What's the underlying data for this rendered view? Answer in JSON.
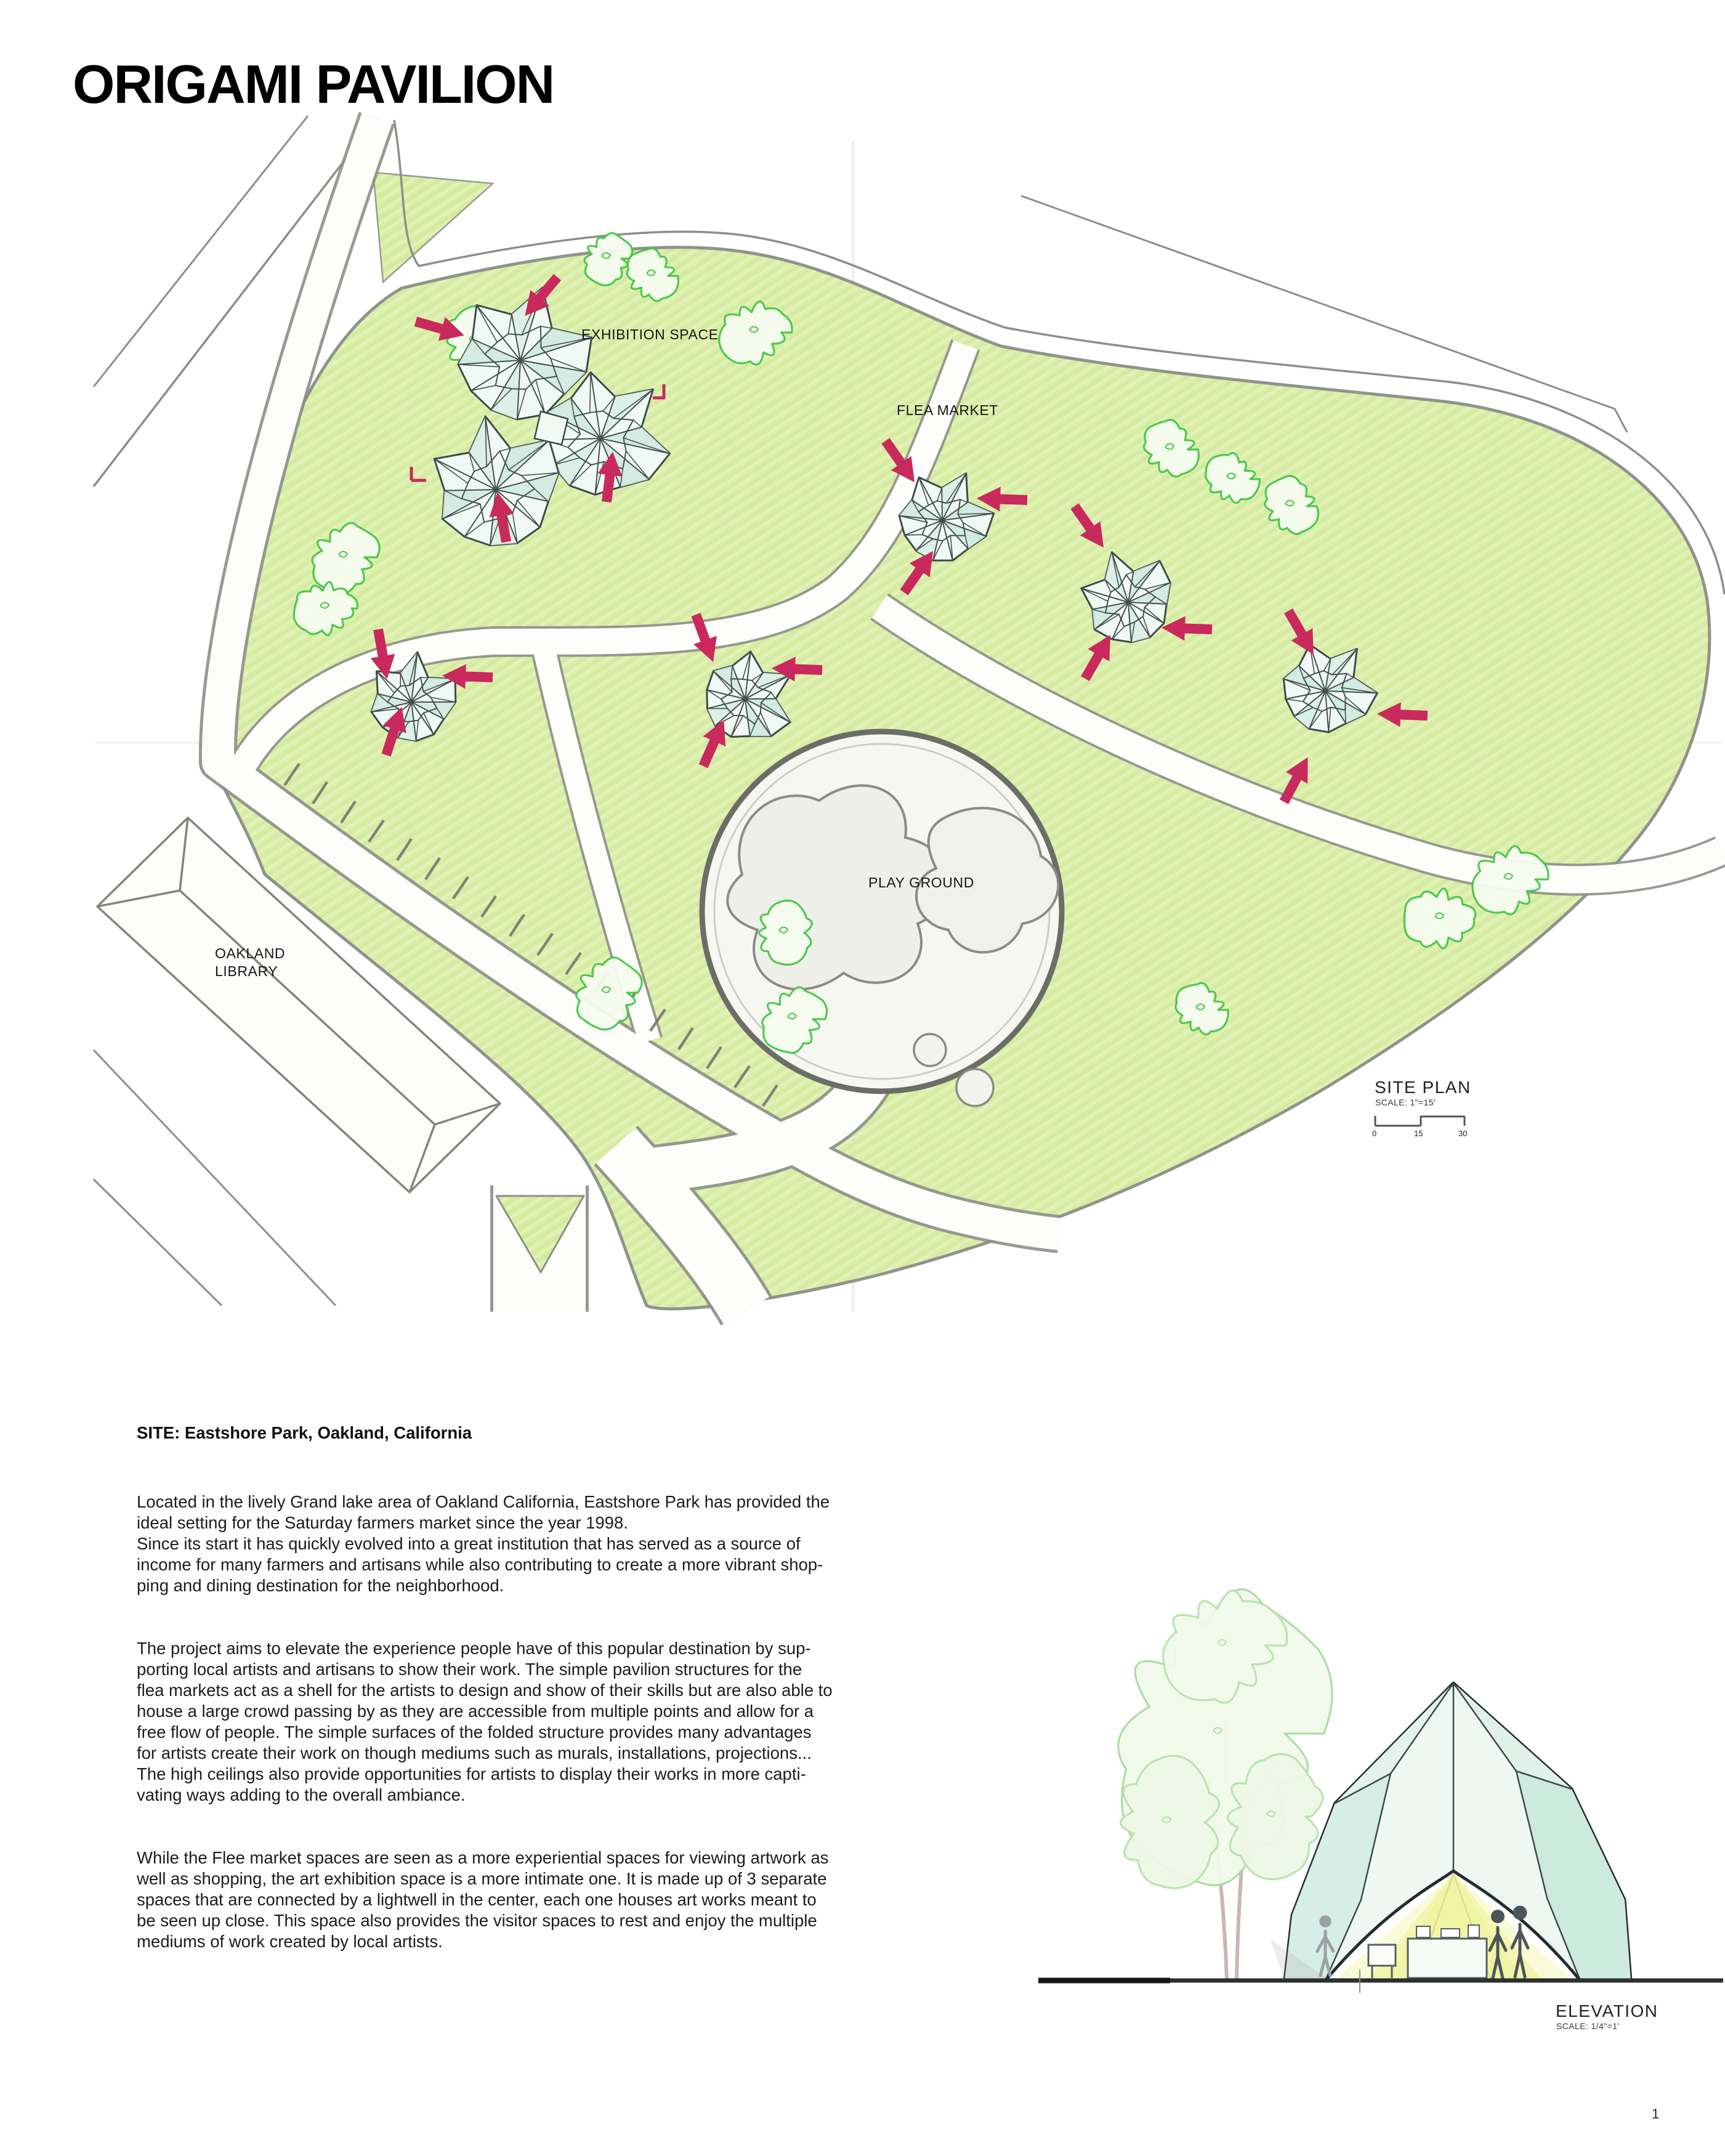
{
  "page": {
    "title": "ORIGAMI PAVILION",
    "page_number": "1"
  },
  "site_plan": {
    "heading": "SITE PLAN",
    "scale_note": "SCALE: 1\"=15'",
    "scale_bar_ticks": [
      "0",
      "15",
      "30"
    ],
    "labels": {
      "exhibition": "EXHIBITION SPACE",
      "flea_market": "FLEA MARKET",
      "playground": "PLAY GROUND",
      "library": "OAKLAND\nLIBRARY"
    }
  },
  "elevation": {
    "heading": "ELEVATION",
    "scale_note": "SCALE: 1/4\"=1'"
  },
  "body": {
    "heading": "SITE: Eastshore Park, Oakland, California",
    "paragraphs": [
      "Located in the lively Grand lake area of Oakland California, Eastshore Park has provided the\nideal setting for the Saturday farmers market since the year 1998.\nSince its start it has quickly evolved into a great institution that has served as a source of\nincome for many farmers and artisans while also contributing to create a more vibrant shop-\nping and dining destination for the neighborhood.",
      "The project aims to elevate the experience people have of this popular destination by sup-\nporting local artists and artisans to show their work. The simple pavilion structures for the\nflea markets act as a shell for the artists to design and show of their skills but are also able to\nhouse a large crowd passing by as they are accessible from multiple points and allow for a\nfree flow of people. The simple surfaces of the folded structure provides many advantages\nfor artists create their work on though mediums such as murals, installations, projections...\nThe high ceilings also provide opportunities for artists to display their works in more capti-\nvating ways adding to the overall ambiance.",
      "While the Flee market spaces are seen as a more experiential spaces for viewing artwork as\nwell as shopping, the art exhibition space is a more intimate one. It is made up of 3 separate\nspaces that are connected by a lightwell in the center, each one houses art works meant to\nbe seen up close. This space also provides the visitor spaces to rest and enjoy the multiple\nmediums of work created by local artists."
    ]
  },
  "colors": {
    "accent_pink": "#c9295c",
    "lawn_green": "#d9eda6",
    "tree_green": "#46c847",
    "pavilion_teal": "#d6eee5",
    "pencil_gray": "#8c8c86"
  }
}
